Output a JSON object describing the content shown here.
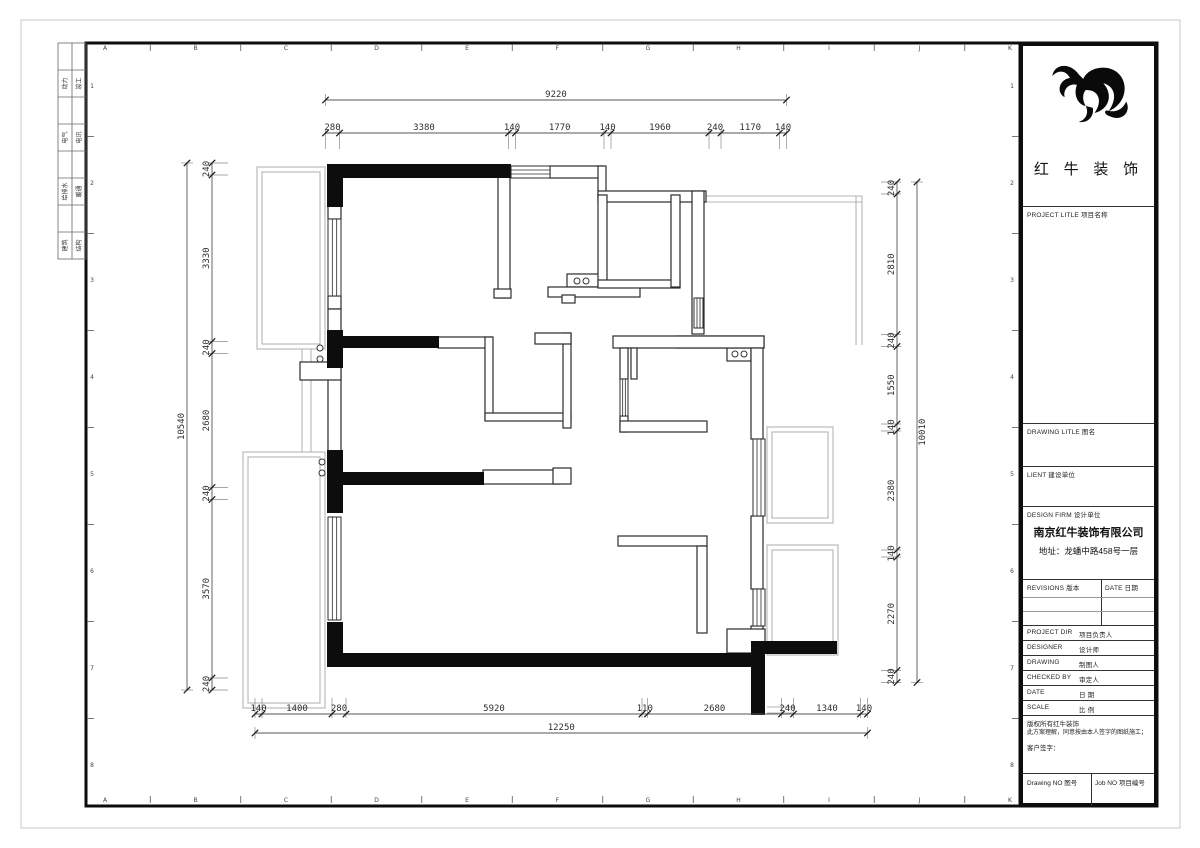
{
  "sheet": {
    "grid_letters": [
      "A",
      "B",
      "C",
      "D",
      "E",
      "F",
      "G",
      "H",
      "I",
      "J",
      "K"
    ],
    "grid_numbers": [
      "1",
      "2",
      "3",
      "4",
      "5",
      "6",
      "7",
      "8"
    ],
    "discipline_rows": [
      {
        "left": "动力",
        "right": "竣工"
      },
      {
        "left": "电气",
        "right": "电讯"
      },
      {
        "left": "给排水",
        "right": "暖通"
      },
      {
        "left": "建筑",
        "right": "结构"
      }
    ]
  },
  "plan": {
    "dimensions": {
      "top": {
        "overall": "9220",
        "segments": [
          "280",
          "3380",
          "140",
          "1770",
          "140",
          "1960",
          "240",
          "1170",
          "140"
        ]
      },
      "left": {
        "overall": "10540",
        "segments": [
          "240",
          "3330",
          "240",
          "2680",
          "240",
          "3570",
          "240"
        ]
      },
      "right": {
        "overall": "10010",
        "segments": [
          "240",
          "2810",
          "240",
          "1550",
          "140",
          "2380",
          "140",
          "2270",
          "240"
        ]
      },
      "bottom": {
        "overall": "12250",
        "segments": [
          "140",
          "1400",
          "280",
          "5920",
          "110",
          "2680",
          "240",
          "1340",
          "140"
        ]
      }
    }
  },
  "title_block": {
    "brand": "红 牛 装 饰",
    "project_title": "PROJECT LITLE  项目名称",
    "drawing_title": "DRAWING LITLE  图名",
    "client": "LIENT 建设单位",
    "design_firm": "DESIGN FIRM  设计单位",
    "company": "南京红牛装饰有限公司",
    "address": "地址：龙蟠中路458号一层",
    "revisions_header": "REVISIONS 版本",
    "date_header": "DATE 日期",
    "staff_rows": [
      {
        "en": "PROJECT DIR",
        "cn": "项目负责人"
      },
      {
        "en": "DESIGNER",
        "cn": "设计师"
      },
      {
        "en": "DRAWING",
        "cn": "制图人"
      },
      {
        "en": "CHECKED BY",
        "cn": "审定人"
      },
      {
        "en": "DATE",
        "cn": "日  期"
      },
      {
        "en": "SCALE",
        "cn": "比  例"
      }
    ],
    "copyright_line1": "版权所有红牛装饰",
    "copyright_line2": "此方案理解，同意按由本人签字的图纸施工；",
    "client_sign": "客户签字：",
    "drawing_no": "Drawing NO 图号",
    "job_no": "Job NO 项目编号"
  }
}
